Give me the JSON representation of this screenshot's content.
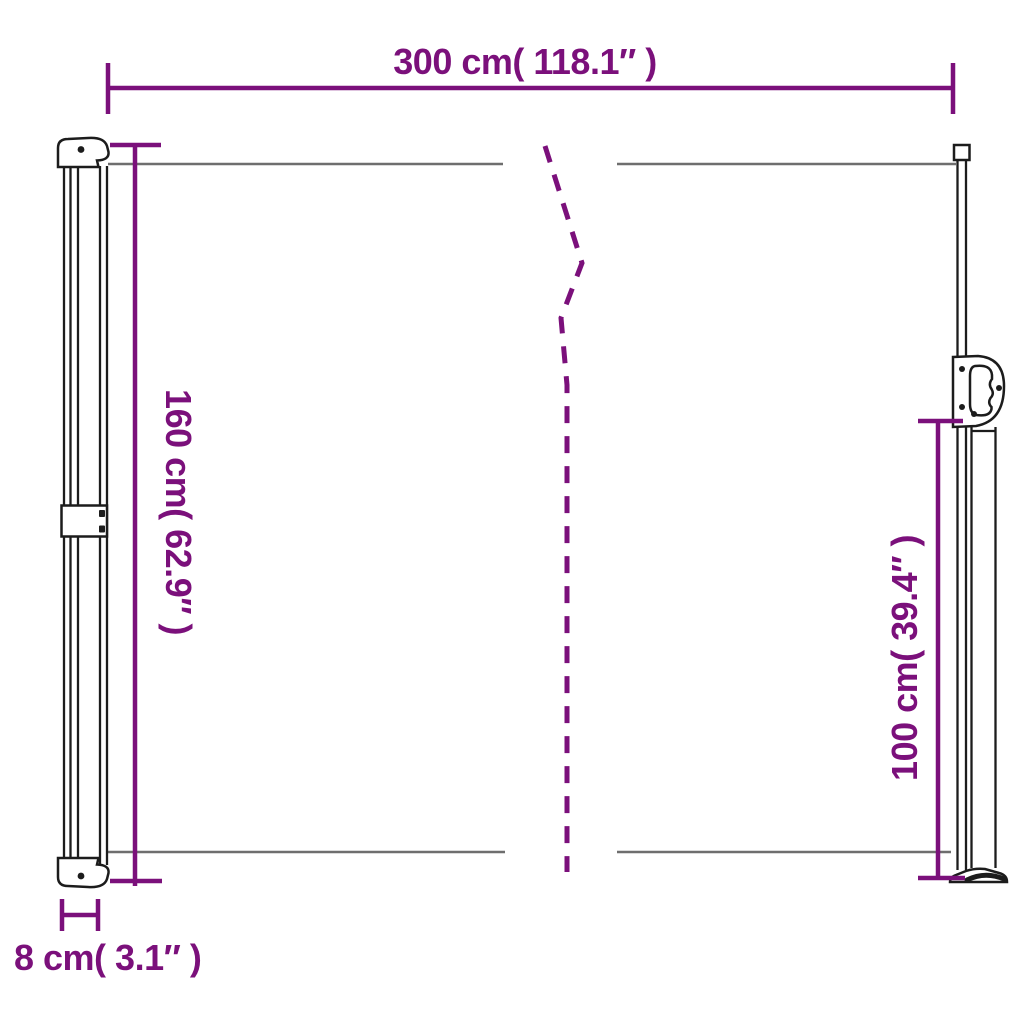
{
  "labels": {
    "width": "300 cm( 118.1″ )",
    "height_left": "160 cm( 62.9″ )",
    "height_right": "100 cm( 39.4″ )",
    "depth": "8 cm( 3.1″ )"
  },
  "colors": {
    "dimension_accent": "#7B107B",
    "outline": "#1c1c1c",
    "fabric_edge": "#6e6e6e",
    "background": "#ffffff"
  }
}
